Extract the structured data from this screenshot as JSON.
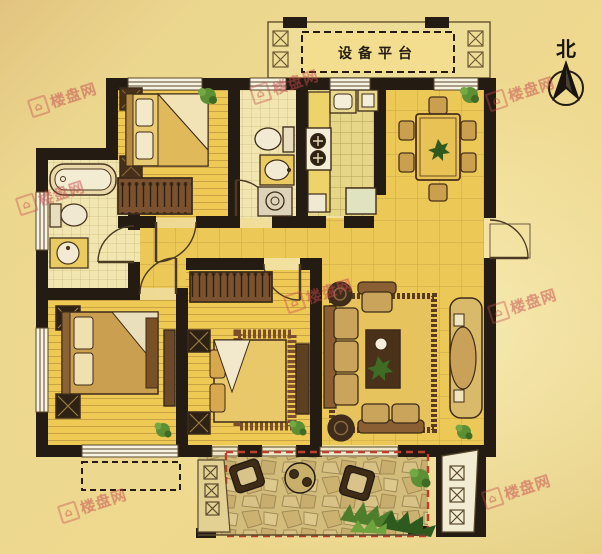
{
  "plan": {
    "equipment_platform_label": "设备平台",
    "north_label": "北"
  },
  "watermark": {
    "text": "楼盘网"
  },
  "colors": {
    "background": "#ecd78f",
    "floor_wood": "#edc84e",
    "floor_tile_light": "#f1e6b0",
    "floor_tile_kitchen": "#e6d687",
    "wall": "#241c12",
    "furniture_brown": "#6b4a2a",
    "terrace_dash_red": "#b8402c",
    "plant_green": "#5d8f35",
    "watermark_red": "#c54a4e"
  }
}
